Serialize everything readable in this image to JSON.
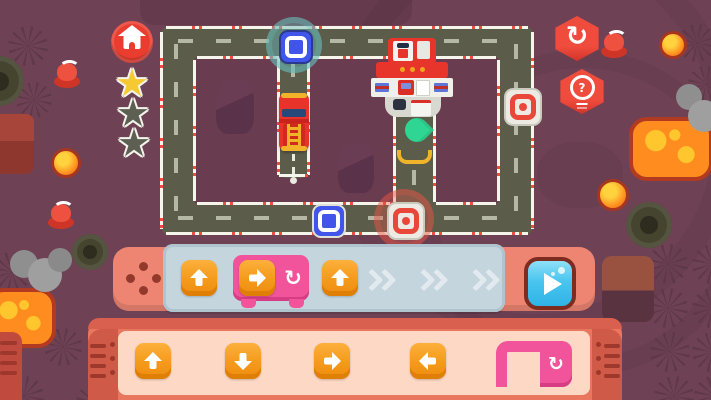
{
  "app": {
    "name": "coding-road-puzzle-level"
  },
  "glyphs": {
    "restart": "↻",
    "loop": "↻",
    "star": "★",
    "question": "?"
  },
  "colors": {
    "background": "#6e4254",
    "road": "#5c5c4b",
    "road_edge_red": "#ef4b3e",
    "command_bar": "#ee8572",
    "command_strip": "#c5d5de",
    "palette_shell": "#e9765f",
    "palette_inner": "#fdd9c5",
    "button_orange": "#f49a1a",
    "loop_pink": "#f2549b",
    "play_cyan": "#49c5ef",
    "accent_red": "#ea3d30",
    "star_gold": "#f6c832",
    "star_empty": "#5d5f52",
    "waypoint_blue": "#4155ea",
    "waypoint_red": "#e8473a",
    "pin_green": "#2fd693"
  },
  "hud": {
    "stars": [
      {
        "state": "earned"
      },
      {
        "state": "empty"
      },
      {
        "state": "empty"
      }
    ]
  },
  "controls": {
    "home": "home",
    "restart": "restart-level",
    "hint": "hint",
    "play": "run-program"
  },
  "program": {
    "slots": [
      {
        "command": "move-up"
      },
      {
        "command": "loop",
        "inner": "move-right"
      },
      {
        "command": "move-up"
      }
    ],
    "empty_slot_count": 3
  },
  "palette": {
    "items": [
      "move-up",
      "move-down",
      "move-right",
      "move-left",
      "loop"
    ]
  },
  "map": {
    "vehicle": "fire-truck",
    "building": "fire-station",
    "pin": "green-destination-pin",
    "waypoints": [
      {
        "color": "blue",
        "location": "top-road",
        "glow": true
      },
      {
        "color": "red",
        "location": "right-road",
        "glow": false
      },
      {
        "color": "blue",
        "location": "bottom-road",
        "glow": false
      },
      {
        "color": "red",
        "location": "bottom-road-junction",
        "glow": true
      }
    ]
  }
}
